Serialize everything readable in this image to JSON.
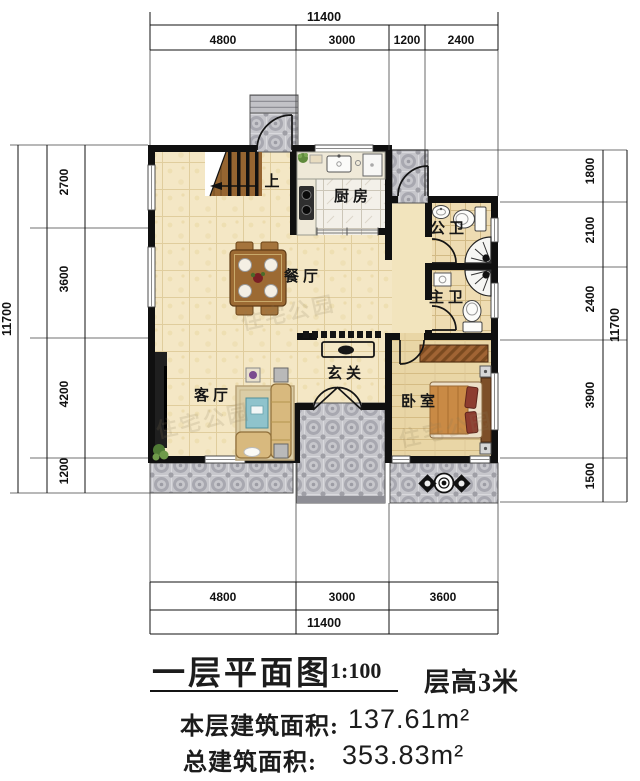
{
  "plan": {
    "title": "一层平面图",
    "scale": "1:100",
    "floor_height": "层高3米",
    "floor_area_label": "本层建筑面积:",
    "floor_area_value": "137.61m²",
    "total_area_label": "总建筑面积:",
    "total_area_value": "353.83m²"
  },
  "rooms": {
    "kitchen": "厨房",
    "dining": "餐厅",
    "living": "客厅",
    "entry": "玄关",
    "bedroom": "卧室",
    "bath_public": "公卫",
    "bath_master": "主卫",
    "stairs_up": "上"
  },
  "dims": {
    "top": {
      "overall": "11400",
      "segments": [
        "4800",
        "3000",
        "1200",
        "2400"
      ]
    },
    "bottom": {
      "overall": "11400",
      "segments": [
        "4800",
        "3000",
        "3600"
      ]
    },
    "left": {
      "overall": "11700",
      "segments": [
        "2700",
        "3600",
        "4200",
        "1200"
      ]
    },
    "right": {
      "overall": "11700",
      "segments": [
        "1800",
        "2100",
        "2400",
        "3900",
        "1500"
      ]
    }
  },
  "watermark": "住宅公园",
  "colors": {
    "wall": "#111111",
    "floor_tile": "#f4e7c5",
    "terrace_tile": "#c9c9ce",
    "wood": "#9c6a33",
    "sofa": "#d8b97e",
    "coffee_table": "#8fc3cc",
    "bed_blanket": "#c98a45"
  }
}
